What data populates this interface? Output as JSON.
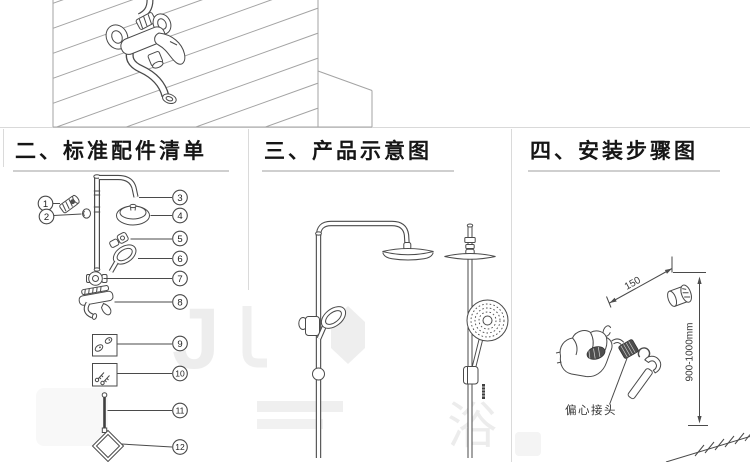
{
  "window": {
    "width": 750,
    "height": 462,
    "background": "#ffffff"
  },
  "colors": {
    "line": "#4a4a4a",
    "panel_line": "#a3a3a3",
    "divider": "#dadada",
    "underline": "#cfcfcf",
    "watermark": "#ededed",
    "dark_fill": "#4e4e4e"
  },
  "figures": {
    "top": "wall-mounted-mixer-faucet-on-tiled-wall",
    "parts": "exploded-parts-diagram",
    "product": "shower-column-two-views",
    "install": "installation-dimensions-with-hand-and-wrench"
  },
  "sections": {
    "parts": {
      "title": "二、标准配件清单",
      "callouts": [
        "1",
        "2",
        "3",
        "4",
        "5",
        "6",
        "7",
        "8",
        "9",
        "10",
        "11",
        "12"
      ]
    },
    "product": {
      "title": "三、产品示意图"
    },
    "install": {
      "title": "四、安装步骤图",
      "width_dim": "150",
      "height_dim": "900-1000mm",
      "connector_label": "偏心接头"
    }
  },
  "watermark": {
    "letter_j": "J",
    "letter_yu": "浴"
  }
}
